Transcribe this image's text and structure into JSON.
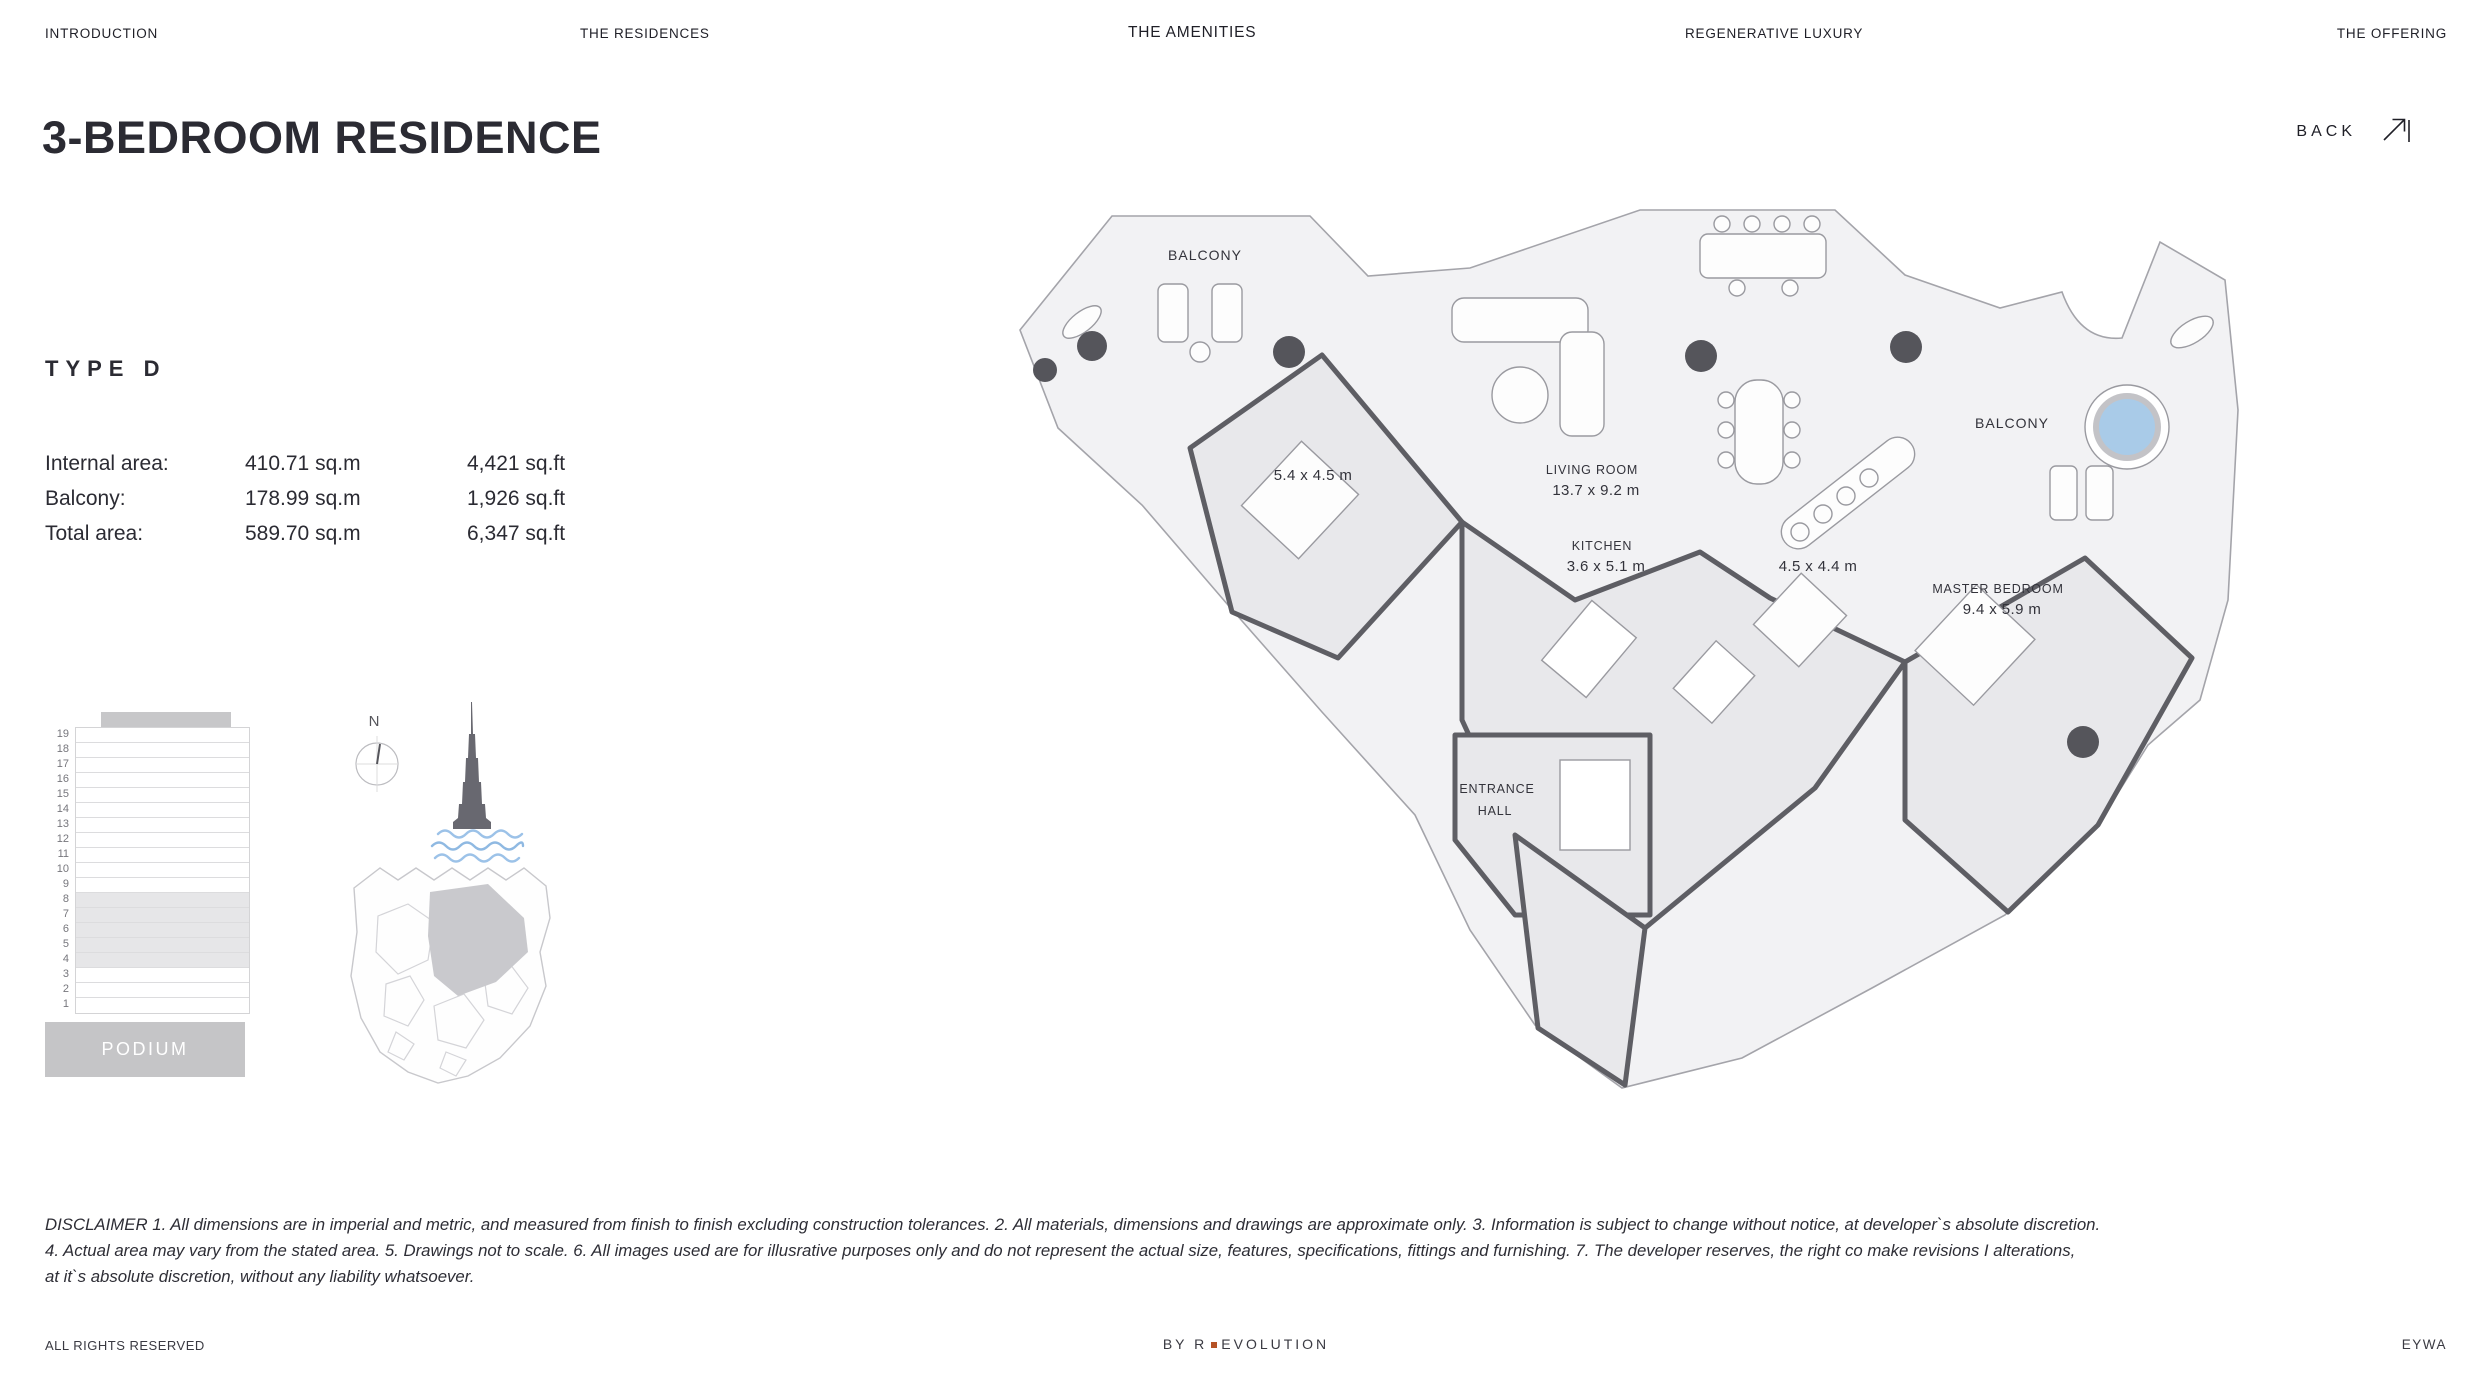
{
  "nav": {
    "items": [
      {
        "label": "INTRODUCTION",
        "active": false
      },
      {
        "label": "THE RESIDENCES",
        "active": false
      },
      {
        "label": "THE AMENITIES",
        "active": true
      },
      {
        "label": "REGENERATIVE LUXURY",
        "active": false
      },
      {
        "label": "THE OFFERING",
        "active": false
      }
    ]
  },
  "back": {
    "label": "BACK",
    "icon": "arrow-up-right-icon"
  },
  "page": {
    "title": "3-BEDROOM RESIDENCE",
    "type_label": "TYPE D"
  },
  "areas": {
    "rows": [
      {
        "label": "Internal area:",
        "metric": "410.71 sq.m",
        "imperial": "4,421 sq.ft"
      },
      {
        "label": "Balcony:",
        "metric": "178.99 sq.m",
        "imperial": "1,926 sq.ft"
      },
      {
        "label": "Total area:",
        "metric": "589.70 sq.m",
        "imperial": "6,347 sq.ft"
      }
    ]
  },
  "building": {
    "floors": [
      19,
      18,
      17,
      16,
      15,
      14,
      13,
      12,
      11,
      10,
      9,
      8,
      7,
      6,
      5,
      4,
      3,
      2,
      1
    ],
    "highlighted_floors": [
      8,
      7,
      6,
      5,
      4
    ],
    "podium_label": "PODIUM"
  },
  "compass": {
    "north_label": "N"
  },
  "floorplan": {
    "labels": {
      "balcony_left": "BALCONY",
      "balcony_right": "BALCONY",
      "living_room_name": "LIVING ROOM",
      "living_room_dims": "13.7 x 9.2 m",
      "kitchen_name": "KITCHEN",
      "kitchen_dims": "3.6 x 5.1 m",
      "bedroom_2_dims": "5.4 x 4.5 m",
      "bedroom_3_dims": "4.5 x 4.4 m",
      "master_bedroom_name": "MASTER BEDROOM",
      "master_bedroom_dims": "9.4 x 5.9 m",
      "entrance_hall_line1": "ENTRANCE",
      "entrance_hall_line2": "HALL"
    },
    "pool_color": "#a9cbe8",
    "wave_color": "#9cc2e8"
  },
  "disclaimer": {
    "lines": [
      "DISCLAIMER 1. All dimensions are in imperial and metric, and measured from finish to finish excluding construction tolerances. 2. All materials, dimensions and drawings are approximate only. 3. Information is subject to change without notice, at developer`s absolute discretion.",
      "4. Actual area may vary from the stated area. 5. Drawings not to scale. 6. All images used are for illusrative purposes only and do not represent the actual size, features, specifications, fittings and furnishing. 7. The developer reserves, the right co make revisions I alterations,",
      "at it`s absolute discretion, without any liability whatsoever."
    ]
  },
  "footer": {
    "left": "ALL RIGHTS RESERVED",
    "by": "BY",
    "brand_first": "R",
    "brand_rest": "EVOLUTION",
    "right": "EYWA",
    "accent_dot_color": "#b55226"
  }
}
